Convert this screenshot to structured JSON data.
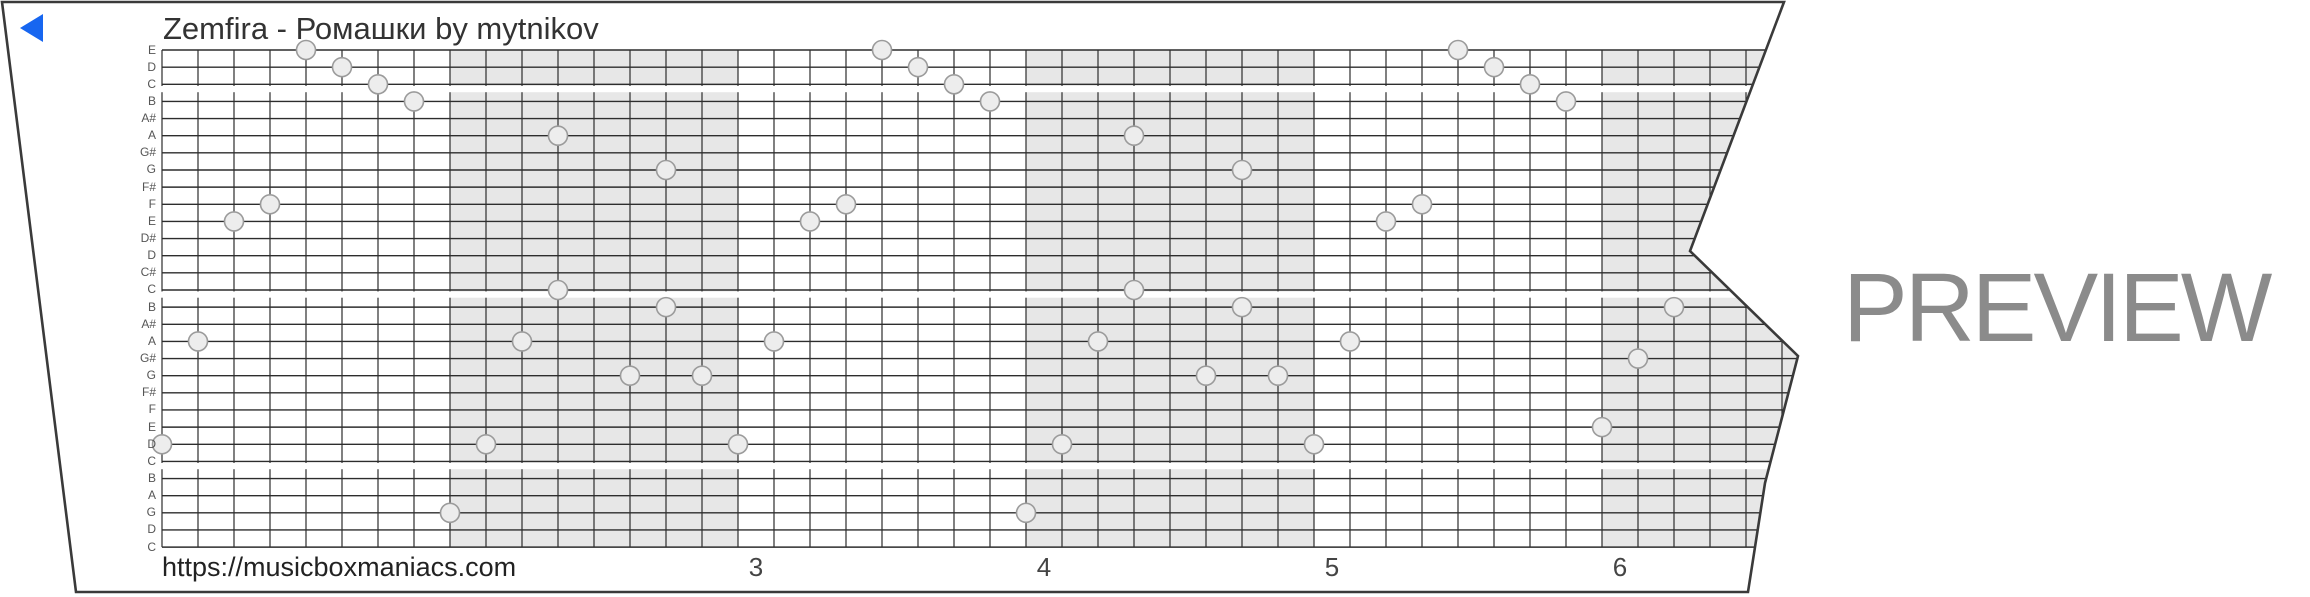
{
  "header": {
    "title": "Zemfira - Ромашки by mytnikov",
    "back_icon": "left-triangle"
  },
  "footer": {
    "url": "https://musicboxmaniacs.com"
  },
  "watermark": {
    "label": "PREVIEW",
    "color": "#8b8b8b"
  },
  "colors": {
    "paper": "#ffffff",
    "outline": "#3a3a3a",
    "grid_line": "#2d2d2d",
    "shaded_measure": "#e7e7e7",
    "gap_stripe": "#ffffff",
    "note_fill": "#ededed",
    "note_stroke": "#9b9b9b",
    "back_icon_blue": "#1766f0"
  },
  "chart_data": {
    "type": "music-box-strip",
    "description": "30-note music box punch strip preview; circles are notes placed on pitch lines",
    "row_labels_top_to_bottom": [
      "E",
      "D",
      "C",
      "B",
      "A#",
      "A",
      "G#",
      "G",
      "F#",
      "F",
      "E",
      "D#",
      "D",
      "C#",
      "C",
      "B",
      "A#",
      "A",
      "G#",
      "G",
      "F#",
      "F",
      "E",
      "D",
      "C",
      "B",
      "A",
      "G",
      "D",
      "C"
    ],
    "layout": {
      "grid_left": 162,
      "grid_top": 50,
      "grid_bottom": 547.1,
      "row_height": 17.142,
      "cell_width": 36,
      "cells_per_measure": 8,
      "measure_width": 288,
      "line_right_limit": 1802,
      "note_radius": 9.5,
      "paper_outline_points": "2,2 1784,2 1690,251 1798,356 1765,483 1748,592 76,592",
      "octave_gap_stripes_y": [
        86,
        291.5,
        463
      ],
      "gap_stripe_height": 6.2,
      "shaded_measure_x": [
        450,
        1026,
        1602
      ]
    },
    "beat_numbers": [
      {
        "label": "3",
        "x": 756
      },
      {
        "label": "4",
        "x": 1044
      },
      {
        "label": "5",
        "x": 1332
      },
      {
        "label": "6",
        "x": 1620
      }
    ],
    "beat_number_top": 553,
    "notes": [
      {
        "x": 162,
        "row": 23
      },
      {
        "x": 198,
        "row": 17
      },
      {
        "x": 234,
        "row": 10
      },
      {
        "x": 270,
        "row": 9
      },
      {
        "x": 306,
        "row": 0
      },
      {
        "x": 342,
        "row": 1
      },
      {
        "x": 378,
        "row": 2
      },
      {
        "x": 414,
        "row": 3
      },
      {
        "x": 450,
        "row": 27
      },
      {
        "x": 486,
        "row": 23
      },
      {
        "x": 522,
        "row": 17
      },
      {
        "x": 558,
        "row": 5
      },
      {
        "x": 558,
        "row": 14
      },
      {
        "x": 630,
        "row": 19
      },
      {
        "x": 666,
        "row": 7
      },
      {
        "x": 666,
        "row": 15
      },
      {
        "x": 702,
        "row": 19
      },
      {
        "x": 738,
        "row": 23
      },
      {
        "x": 774,
        "row": 17
      },
      {
        "x": 810,
        "row": 10
      },
      {
        "x": 846,
        "row": 9
      },
      {
        "x": 882,
        "row": 0
      },
      {
        "x": 918,
        "row": 1
      },
      {
        "x": 954,
        "row": 2
      },
      {
        "x": 990,
        "row": 3
      },
      {
        "x": 1026,
        "row": 27
      },
      {
        "x": 1062,
        "row": 23
      },
      {
        "x": 1098,
        "row": 17
      },
      {
        "x": 1134,
        "row": 5
      },
      {
        "x": 1134,
        "row": 14
      },
      {
        "x": 1206,
        "row": 19
      },
      {
        "x": 1242,
        "row": 7
      },
      {
        "x": 1242,
        "row": 15
      },
      {
        "x": 1278,
        "row": 19
      },
      {
        "x": 1314,
        "row": 23
      },
      {
        "x": 1350,
        "row": 17
      },
      {
        "x": 1386,
        "row": 10
      },
      {
        "x": 1422,
        "row": 9
      },
      {
        "x": 1458,
        "row": 0
      },
      {
        "x": 1494,
        "row": 1
      },
      {
        "x": 1530,
        "row": 2
      },
      {
        "x": 1566,
        "row": 3
      },
      {
        "x": 1602,
        "row": 22
      },
      {
        "x": 1638,
        "row": 18
      },
      {
        "x": 1674,
        "row": 15
      }
    ]
  }
}
